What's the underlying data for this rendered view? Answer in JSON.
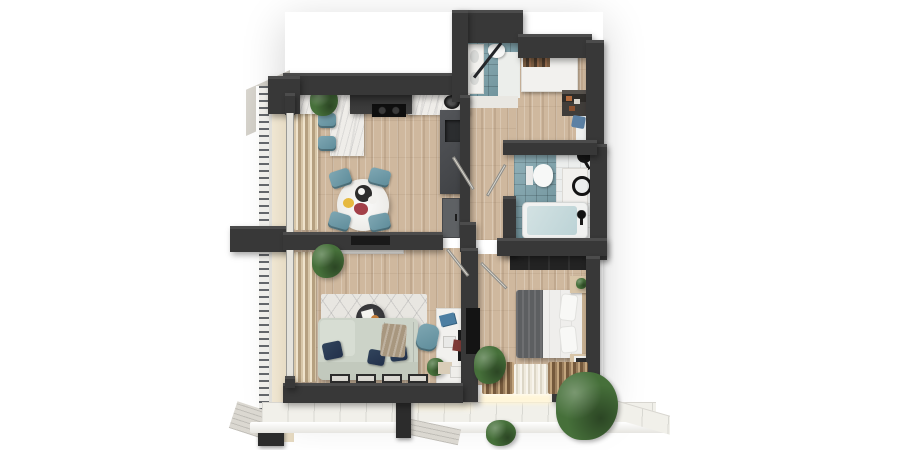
{
  "scene": {
    "type": "3d-floorplan-render",
    "label": "Apartment floor plan - top-down 3D render",
    "background": "#ffffff"
  },
  "palette": {
    "wall": "#383838",
    "wood_floor": "#cfb89e",
    "teal_tile": "#78a0aa",
    "accent_teal": "#6f9dab",
    "accent_navy": "#2a3b52",
    "sofa_sage": "#ccd3c8",
    "marble": "#efede9",
    "curtain_beige": "#c9b695",
    "plant_green": "#46703a",
    "terrace_tile": "#f1f0ea"
  },
  "rooms": {
    "kitchen_dining": {
      "label": "Kitchen and dining room",
      "floor": "wood",
      "items": "kitchen counter, hood, cooktop, sink cabinet, bar stools, round dining table, 4 teal chairs, plant, curtains"
    },
    "living_room": {
      "label": "Living room",
      "floor": "wood",
      "items": "sofa with navy pillows, throw, rug, coffee table, TV console, desk, monitor, desk chair, plants, curtains"
    },
    "bedroom": {
      "label": "Bedroom",
      "floor": "wood",
      "items": "double bed, gray throw, pillows, nightstands, wardrobe, wall TV, plant, curtains"
    },
    "bathroom": {
      "label": "Bathroom",
      "floor": "teal tile",
      "items": "bathtub, vanity with round mirror, toilet, shower head"
    },
    "wc": {
      "label": "Guest WC",
      "floor": "teal tile",
      "items": "vanity, toilet, shower screen"
    },
    "hallway": {
      "label": "Hallway",
      "floor": "wood",
      "items": "open doors"
    },
    "entry": {
      "label": "Entry hall",
      "floor": "wood",
      "items": "wardrobe, shoe shelf"
    },
    "balcony": {
      "label": "Side balcony",
      "floor": "screed",
      "items": "railing"
    },
    "terrace": {
      "label": "Bottom terrace",
      "floor": "white tile",
      "items": "plants, pillars"
    }
  }
}
